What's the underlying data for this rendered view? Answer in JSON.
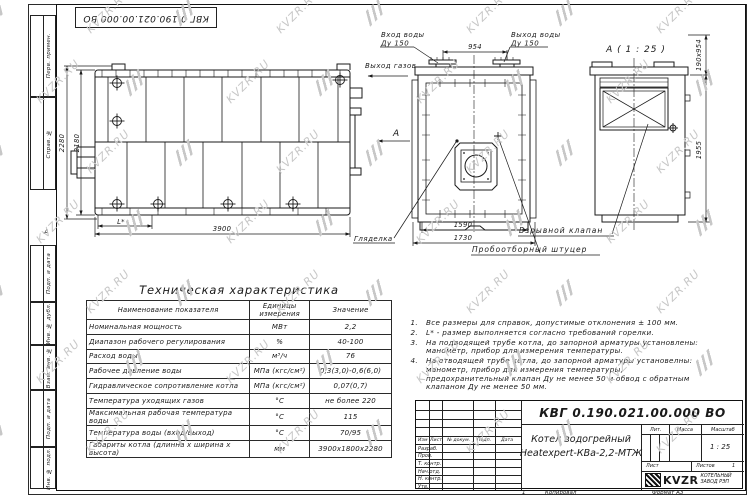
{
  "watermark": {
    "text": "KVZR.RU"
  },
  "top_stamp": {
    "code": "КВГ 0.190.021.00.000 ВО"
  },
  "margin": {
    "zone_letter": "А",
    "top_labels": [
      "Перв. примен.",
      "Справ. №"
    ],
    "bottom_labels": [
      "Подп. и дата",
      "Инв. № дубл.",
      "Взам. инв. №",
      "Подп. и дата",
      "Инв. № подл."
    ]
  },
  "drawing": {
    "view_a_title": "А ( 1 : 25 )",
    "labels": {
      "water_inlet": [
        "Вход воды",
        "Ду 150"
      ],
      "water_outlet": [
        "Выход воды",
        "Ду 150"
      ],
      "gas_outlet": "Выход газов",
      "view_arrow": "А",
      "sight_glass": "Гляделка",
      "explosion_valve": "Взрывной клапан",
      "sampling_fitting": "Пробоотборный штуцер"
    },
    "dims": {
      "front_top": "954",
      "front_inner": "1590",
      "front_outer": "1730",
      "side_width": "3900",
      "side_height_outer": "2280",
      "side_height_inner": "2180",
      "side_burner": "L*",
      "detail_opening": "190х954",
      "detail_height": "1955"
    }
  },
  "spec_table": {
    "title": "Техническая характеристика",
    "headers": [
      "Наименование показателя",
      "Единицы измерения",
      "Значение"
    ],
    "rows": [
      [
        "Номинальная мощность",
        "МВт",
        "2,2"
      ],
      [
        "Диапазон рабочего регулирования",
        "%",
        "40-100"
      ],
      [
        "Расход воды",
        "м³/ч",
        "76"
      ],
      [
        "Рабочее давление воды",
        "МПа (кгс/см²)",
        "0,3(3,0)-0,6(6,0)"
      ],
      [
        "Гидравлическое сопротивление котла",
        "МПа (кгс/см²)",
        "0,07(0,7)"
      ],
      [
        "Температура уходящих газов",
        "°С",
        "не более 220"
      ],
      [
        "Максимальная рабочая температура воды",
        "°С",
        "115"
      ],
      [
        "Температура воды (вход/выход)",
        "°С",
        "70/95"
      ],
      [
        "Габариты котла (длинна х ширина х высота)",
        "мм",
        "3900х1800х2280"
      ]
    ]
  },
  "notes": [
    "Все размеры для справок, допустимые отклонения ± 100 мм.",
    "L* - размер выполняется согласно требований горелки.",
    "На подводящей трубе котла, до запорной арматуры установлены: манометр, прибор для измерения температуры.",
    "На отводящей трубе котла, до запорной арматуры установелны: манометр, прибор для измерения температуры, предохранительный клапан Ду не менее 50 и обвод с обратным клапаном Ду не менее 50 мм."
  ],
  "title_block": {
    "doc_number": "КВГ 0.190.021.00.000 ВО",
    "product_name": [
      "Котел водогрейный",
      "Heatexpert-КВа-2,2-МТЖ"
    ],
    "change_header": [
      "Изм",
      "Лист",
      "№ докум.",
      "Подп.",
      "Дата"
    ],
    "roles": [
      "Разраб.",
      "Пров.",
      "Т. контр.",
      "Нач.отд.",
      "Н. контр.",
      "Утв."
    ],
    "lit_label": "Лит.",
    "mass_label": "Масса",
    "scale_label": "Масштаб",
    "scale_value": "1 : 25",
    "sheet_label": "Лист",
    "sheets_label": "Листов",
    "sheets_value": "1",
    "company": {
      "abbr": "KVZR",
      "line1": "КОТЕЛЬНЫЙ",
      "line2": "ЗАВОД РЭП"
    },
    "copy_num": "1",
    "copied_label": "Копировал",
    "format_label": "Формат А3"
  }
}
